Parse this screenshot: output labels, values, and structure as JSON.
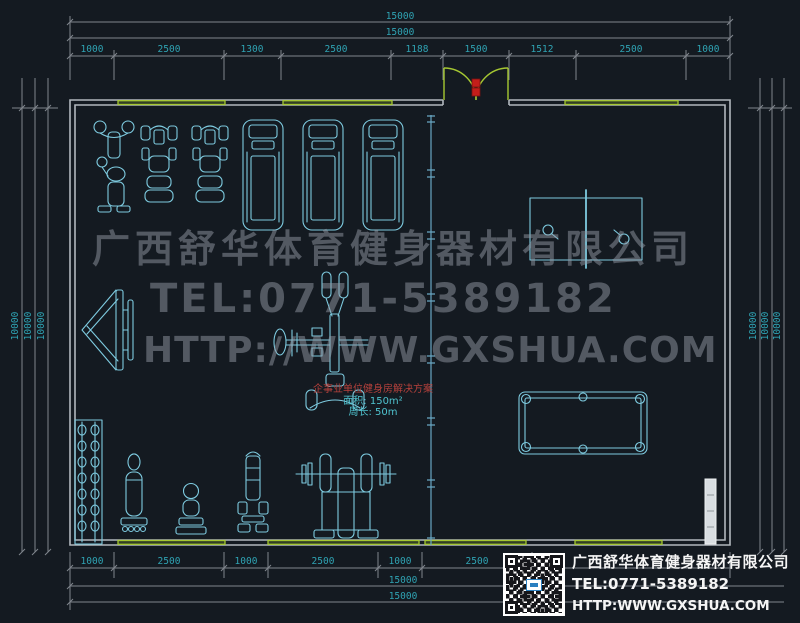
{
  "watermark": {
    "company": "广西舒华体育健身器材有限公司",
    "tel": "TEL:0771-5389182",
    "url": "HTTP://WWW.GXSHUA.COM"
  },
  "title_block": {
    "company": "广西舒华体育健身器材有限公司",
    "tel": "TEL:0771-5389182",
    "url": "HTTP:WWW.GXSHUA.COM",
    "qr_icon": "qr-code"
  },
  "room_label": {
    "line1": "企事业单位健身房解决方案",
    "line2": "面积: 150m²",
    "line3": "周长: 50m"
  },
  "dimensions": {
    "top_total_outer": "15000",
    "top_total_inner": "15000",
    "top_segments": [
      "1000",
      "2500",
      "1300",
      "2500",
      "1188",
      "1500",
      "1512",
      "2500",
      "1000"
    ],
    "bottom_segments": [
      "1000",
      "2500",
      "1000",
      "2500",
      "1000",
      "2500"
    ],
    "bottom_total_inner": "15000",
    "bottom_total_outer": "15000",
    "left": [
      "10000",
      "10000",
      "10000"
    ],
    "right": [
      "10000",
      "10000",
      "10000"
    ]
  },
  "equipment_icons": [
    "elliptical-trainer",
    "exercise-bike",
    "exercise-bike",
    "treadmill",
    "treadmill",
    "treadmill",
    "sit-up-bench",
    "multi-station-gym",
    "dumbbell-rack",
    "weight-machine",
    "stool",
    "weight-machine",
    "bench-press",
    "table-tennis-table",
    "billiard-table"
  ],
  "colors": {
    "background": "#141a21",
    "wall": "#b2b8be",
    "dim_line": "#80868d",
    "dim_text": "#2fa3b3",
    "equipment": "#7ecbe0",
    "window": "#a6c832",
    "door_red": "#c41e1a",
    "partition": "#69a7c4",
    "watermark": "#9198a3",
    "label_red": "#b5413c",
    "label_cyan": "#4fc3cf",
    "title_text": "#f5f5f5"
  }
}
